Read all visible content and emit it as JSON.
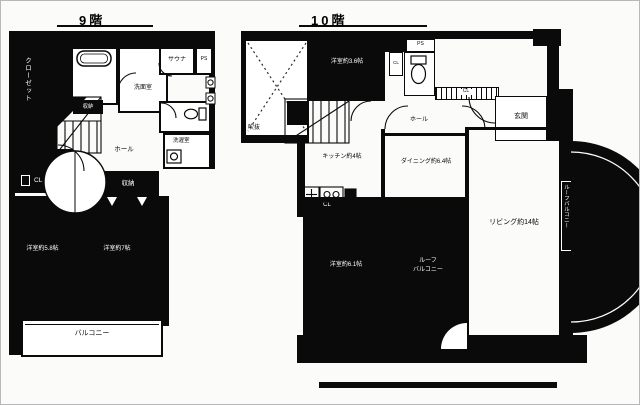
{
  "floor9": {
    "title": "9階",
    "labels": {
      "closet": "クローゼット",
      "sauna": "サウナ",
      "ps": "PS",
      "washroom": "洗面室",
      "laundry": "洗濯室",
      "storage_stairs": "収納",
      "hall": "ホール",
      "cl": "CL",
      "storage": "収納",
      "bedroom_left": "洋室約5.8帖",
      "bedroom_right": "洋室約7帖",
      "balcony": "バルコニー"
    }
  },
  "floor10": {
    "title": "10階",
    "labels": {
      "void": "吹抜",
      "bedroom_top": "洋室約3.6帖",
      "ps": "PS",
      "cl_top": "CL",
      "cl_strip": "CL",
      "hall": "ホール",
      "entrance": "玄関",
      "kitchen": "キッチン約4帖",
      "dining": "ダイニング約6.4帖",
      "living": "リビング約14帖",
      "roof_balcony_side": "ルーフバルコニー",
      "bedroom_bottom": "洋室約6.1帖",
      "cl_bottom": "CL",
      "roof_balcony_line1": "ルーフ",
      "roof_balcony_line2": "バルコニー"
    }
  },
  "colors": {
    "ink": "#0a0a0a",
    "paper": "#ffffff"
  }
}
